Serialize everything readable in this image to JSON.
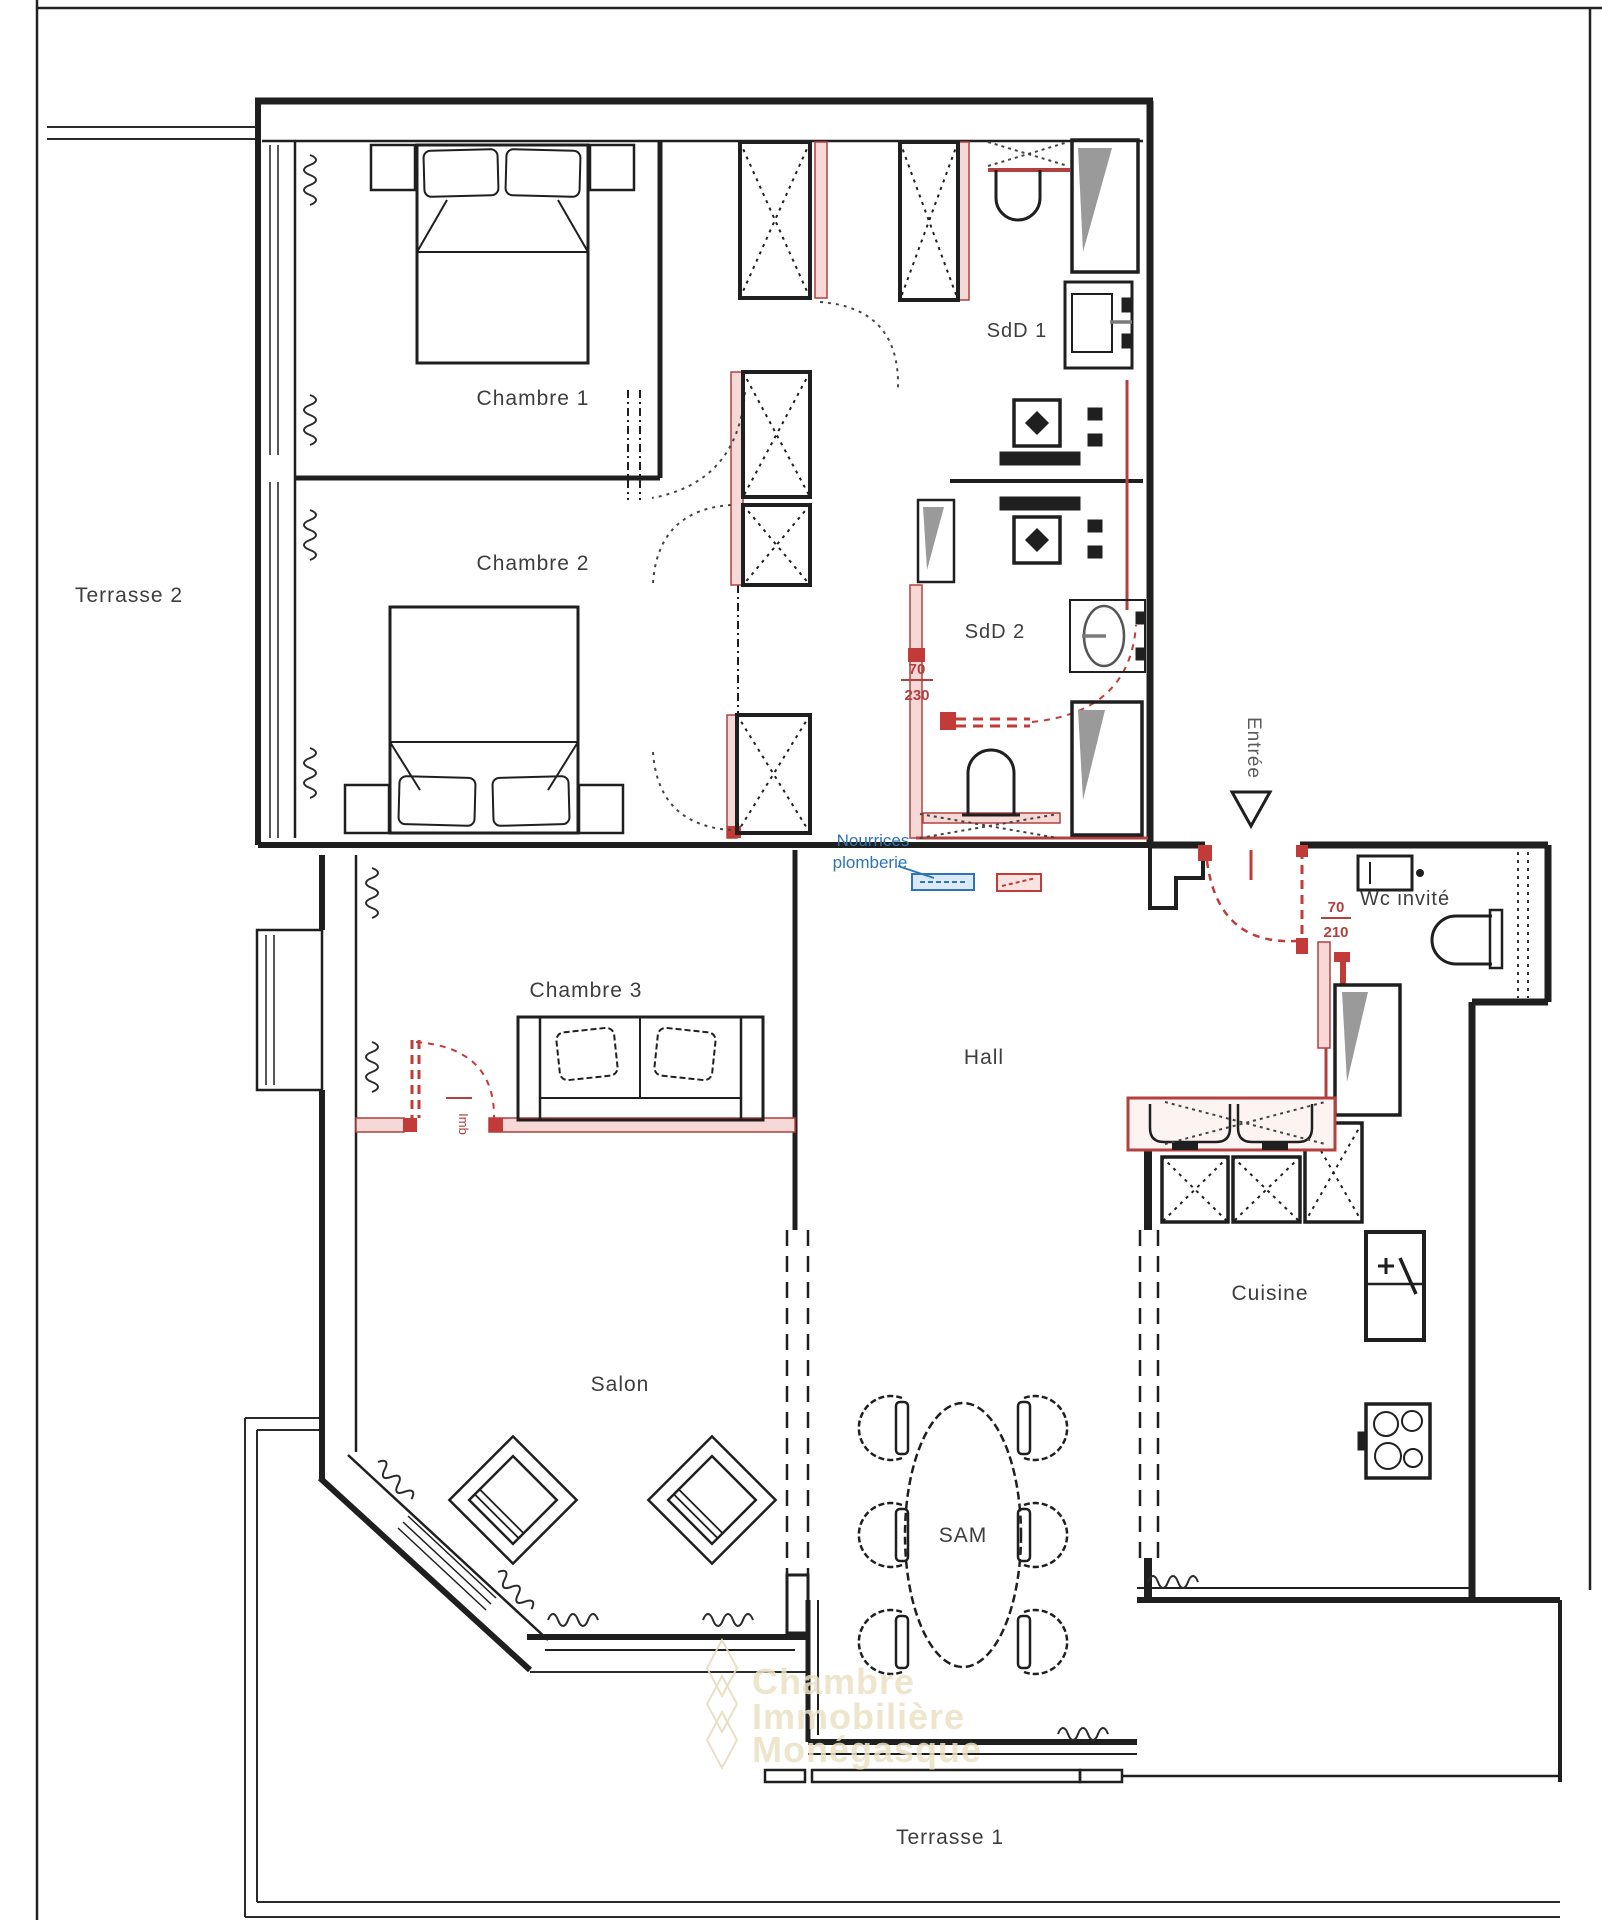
{
  "document": {
    "type": "architect-floor-plan",
    "background": "#ffffff"
  },
  "colors": {
    "walls": "#1f1f1f",
    "new_walls_red": "#b0413e",
    "new_walls_fill": "#f6d9d6",
    "plumbing_blue": "#2e75b6",
    "shower_gray": "#9a9a9a",
    "label_gray": "#3d3d3d",
    "watermark": "#ede1c6"
  },
  "labels": {
    "terrasse2": "Terrasse 2",
    "chambre1": "Chambre 1",
    "chambre2": "Chambre 2",
    "chambre3": "Chambre 3",
    "salon": "Salon",
    "sam": "SAM",
    "hall": "Hall",
    "cuisine": "Cuisine",
    "sdd1": "SdD 1",
    "sdd2": "SdD 2",
    "wc_invite": "Wc invité",
    "terrasse1": "Terrasse 1",
    "entree": "Entrée",
    "imb": "Imb"
  },
  "doors": {
    "sdd2": {
      "width": "70",
      "height": "230"
    },
    "wc": {
      "width": "70",
      "height": "210"
    }
  },
  "plumbing_note": {
    "line1": "Nourrices",
    "line2": "plomberie"
  },
  "watermark": {
    "line1": "Chambre",
    "line2": "Immobilière",
    "line3": "Monégasque"
  }
}
